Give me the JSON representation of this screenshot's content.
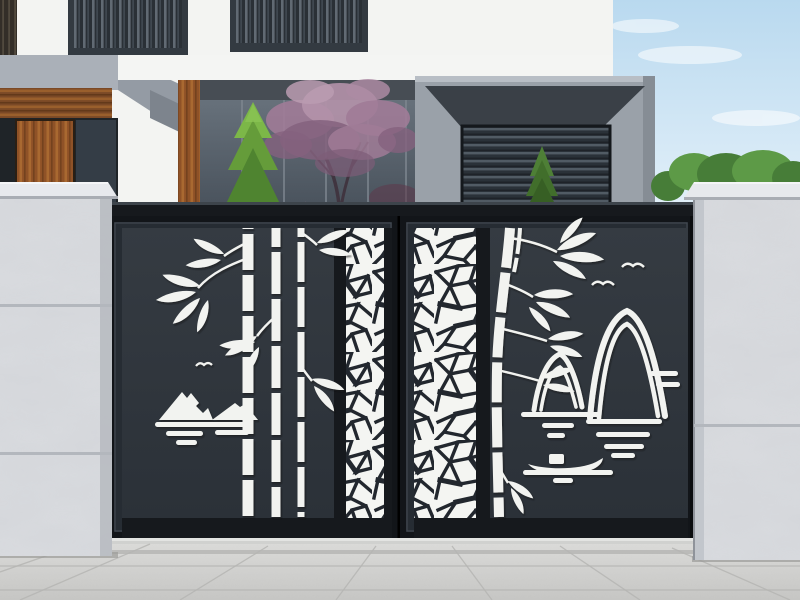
{
  "meta": {
    "type": "product-photograph",
    "alt": "Black laser-cut metal double driveway gate decorated with bamboo, mountains, birds, a boat and cracked-ice lattice panels, mounted between two grey marble pillars in front of a modern white villa"
  },
  "labels": {
    "photo": "gate product photo",
    "sky": "blue sky with soft clouds",
    "house": "modern white villa facade",
    "window_left": "slatted window upper left",
    "window_center": "slatted window upper center",
    "canopy": "grey metal canopy with wood soffit",
    "door": "wooden entry door",
    "glass": "glass curtain wall",
    "conifer": "tall green cypress tree",
    "blossom": "pink blossom tree in courtyard",
    "garage": "grey garage volume with louvered panel",
    "garage_conifer": "small conifer in front of garage",
    "bushes": "green shrubs behind right wall",
    "left_pillar": "left marble gate pillar",
    "right_pillar": "right marble gate pillar",
    "gate": "black laser-cut double swing gate",
    "left_leaf": "left gate leaf",
    "right_leaf": "right gate leaf",
    "bamboo_left": "bamboo cutout motif, left leaf",
    "bamboo_right": "bamboo cutout motif, right leaf",
    "crackle_left": "cracked-ice lattice strip, left leaf",
    "crackle_right": "cracked-ice lattice strip, right leaf",
    "mountain_left": "snow mountain and water cutout motif",
    "mountain_right": "line-art mountain cutout motif",
    "birds": "flying bird cutouts",
    "water": "water ripple cutout bars",
    "boat": "small boat cutout",
    "threshold": "concrete gate threshold",
    "ground": "grey paved driveway"
  },
  "colors": {
    "sky_top": "#b9d9ef",
    "sky_bottom": "#eaf4fb",
    "cloud": "#ffffff",
    "wall": "#f3f4f2",
    "fascia": "#f4f5f3",
    "metal_light": "#aab0b8",
    "metal_mid": "#949ba4",
    "metal_dark": "#7d848d",
    "soffit": "#474d54",
    "garage_body": "#9aa1a9",
    "garage_soffit": "#3a4047",
    "louver_base": "#2a3138",
    "louver_line": "#515b64",
    "window_frame": "#333a41",
    "window_base": "#2a3036",
    "window_slat": "#6b757e",
    "wood_base": "#8f5227",
    "wood_light": "#a96931",
    "wood_shadow": "#6e3d1c",
    "door_interior": "#1f2428",
    "glass_top": "#67717b",
    "glass_bottom": "#47505a",
    "mullion": "#7e8790",
    "conifer_light": "#7cb748",
    "conifer_mid": "#659c3a",
    "conifer_dark": "#4f8430",
    "small_conifer_light": "#4e7f36",
    "small_conifer_mid": "#416e2b",
    "small_conifer_dark": "#375f24",
    "blossom_light": "#b492aa",
    "blossom_mid": "#a07b97",
    "blossom_dark": "#84617e",
    "trunk": "#403540",
    "bush": "#5d9a47",
    "bush_dark": "#477d38",
    "pillar_face": "#d9dbdf",
    "pillar_cap": "#e7e9ed",
    "pillar_edge": "#b6bac0",
    "pillar_joint": "#b3b7bd",
    "gate_frame": "#16191d",
    "gate_frame_mid": "#262c33",
    "gate_highlight": "#3d444b",
    "panel_top": "#353b42",
    "panel_bottom": "#2b3138",
    "cutout": "#f2f3f0",
    "crackle_bg": "#f4f5f2",
    "crackle_line": "#22272e",
    "threshold": "#d0d1cf",
    "threshold_lip": "#e3e4e2",
    "ground_top": "#dadad8",
    "ground_bottom": "#c5c5c3",
    "ground_line": "#b5b5b3",
    "shadow": "#0c0e11"
  }
}
